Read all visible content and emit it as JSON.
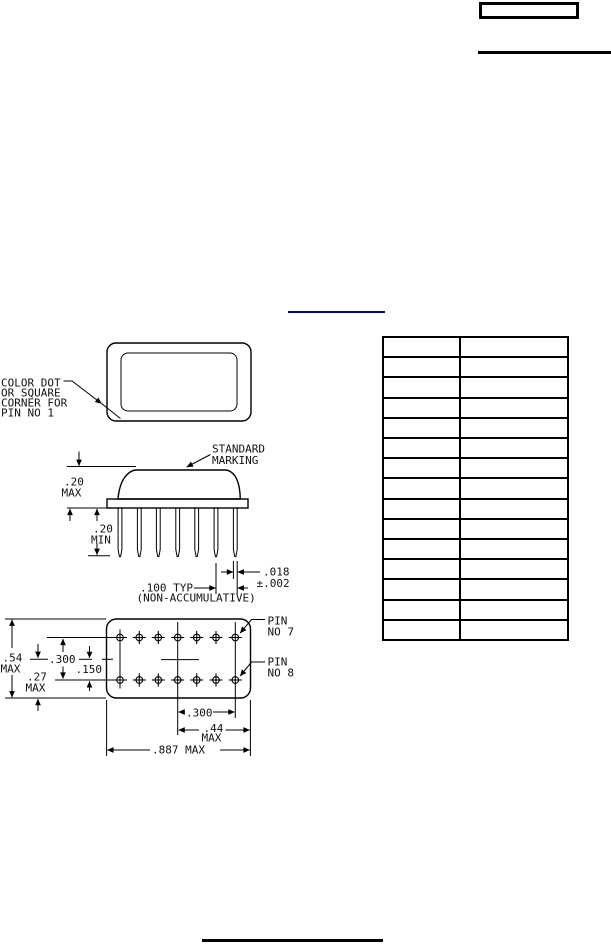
{
  "colors": {
    "ink": "#000000",
    "link_underline": "#00009a",
    "background": "#ffffff"
  },
  "header": {
    "box_text": ""
  },
  "top_view": {
    "note": [
      "COLOR DOT",
      "OR SQUARE",
      "CORNER FOR",
      "PIN NO 1"
    ]
  },
  "side_view": {
    "marking": [
      "STANDARD",
      "MARKING"
    ],
    "dims": {
      "body_height": [
        ".20",
        "MAX"
      ],
      "lead_length": [
        ".20",
        "MIN"
      ],
      "lead_dia": [
        ".018",
        "±.002"
      ],
      "pitch": [
        ".100 TYP",
        "(NON-ACCUMULATIVE)"
      ]
    }
  },
  "bottom_view": {
    "dims": {
      "overall_height": [
        ".54",
        "MAX"
      ],
      "half_height": [
        ".27",
        "MAX"
      ],
      "row_spacing": ".300",
      "half_row_spacing": ".150",
      "pin_span": ".300",
      "half_length": [
        ".44",
        "MAX"
      ],
      "overall_length": ".887 MAX"
    },
    "pin_labels": {
      "pin7": [
        "PIN",
        "NO 7"
      ],
      "pin8": [
        "PIN",
        "NO 8"
      ]
    }
  },
  "table": {
    "row_count": 15,
    "col_count": 2
  }
}
